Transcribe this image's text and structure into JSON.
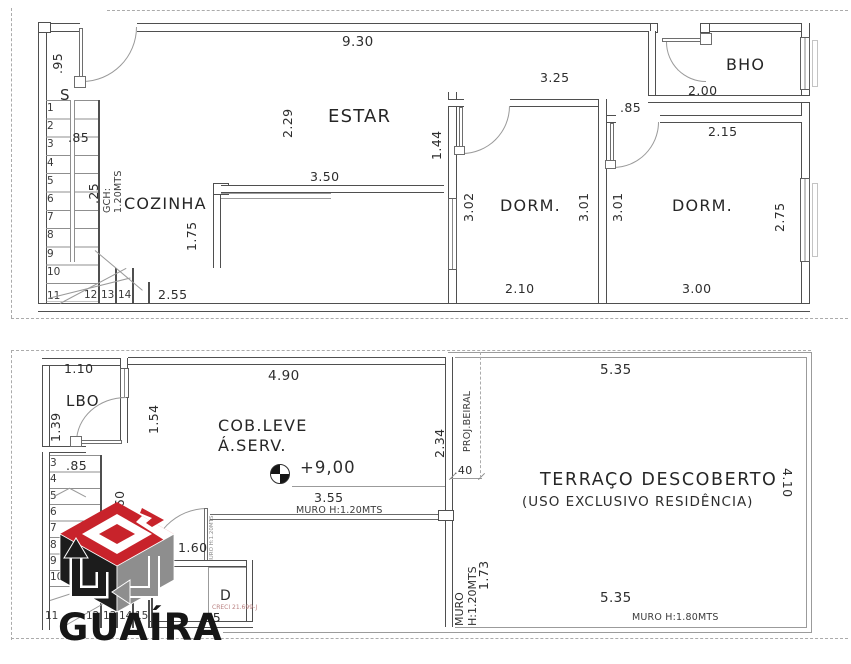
{
  "upper_plan": {
    "rooms": {
      "cozinha": "COZINHA",
      "estar": "ESTAR",
      "dorm1": "DORM.",
      "dorm2": "DORM.",
      "bho": "BHO"
    },
    "dims": {
      "entry_door": ".95",
      "total_width": "9.30",
      "estar_height": "2.29",
      "dorm1_top": "3.25",
      "hall_width": "1.44",
      "kitchen_wall": "3.50",
      "kitchen_height": "1.75",
      "kitchen_width": "2.55",
      "stair_width": ".85",
      "stair_tread": ".25",
      "stair_note": "GCH: 1.20MTS",
      "dorm1_left": "3.02",
      "dorm1_right": "3.01",
      "dorm1_width": "2.10",
      "dorm2_left": "3.01",
      "dorm2_door": ".85",
      "dorm2_window": "2.75",
      "dorm2_width": "3.00",
      "bho_width": "2.00",
      "dorm2_top": "2.15"
    },
    "stairs_label": "S",
    "stairs_side": [
      "1",
      "2",
      "3",
      "4",
      "5",
      "6",
      "7",
      "8",
      "9",
      "10",
      "11"
    ],
    "stairs_bottom": [
      "12",
      "13",
      "14"
    ]
  },
  "lower_plan": {
    "rooms": {
      "lbo": "LBO",
      "cob_line1": "COB.LEVE",
      "cob_line2": "Á.SERV.",
      "terraco_line1": "TERRAÇO DESCOBERTO",
      "terraco_line2": "(USO EXCLUSIVO RESIDÊNCIA)"
    },
    "level_mark": "+9,00",
    "dims": {
      "lbo_top": "1.10",
      "lbo_left": "1.39",
      "lbo_right": "1.54",
      "cob_top": "4.90",
      "cob_right": "2.34",
      "beiral": "PROJ.BEIRAL",
      "beiral_gap": ".40",
      "level_width": "3.55",
      "muro_mid": "MURO H:1.20MTS",
      "muro_door": "MURO H:1.20MTS",
      "muro_right": "MURO H:1.20MTS",
      "muro_right_len": "1.73",
      "terraco_top": "5.35",
      "terraco_right": "4.10",
      "terraco_bottom": "5.35",
      "muro_bottom": "MURO H:1.80MTS",
      "stair_width": ".85",
      "stair_run": "1.60",
      "door_run": "1.60",
      "d_room": "D",
      "d_width": ".95"
    },
    "stairs_side": [
      "3",
      "4",
      "5",
      "6",
      "7",
      "8",
      "9",
      "10"
    ],
    "stairs_bottom": [
      "11",
      "12",
      "13",
      "14",
      "15"
    ]
  },
  "brand": {
    "name": "GUAÍRA",
    "creci": "CRECI 21.699-J",
    "logo_red": "#c8232b",
    "logo_black": "#1c1c1c",
    "logo_gray": "#8e8e8e"
  }
}
